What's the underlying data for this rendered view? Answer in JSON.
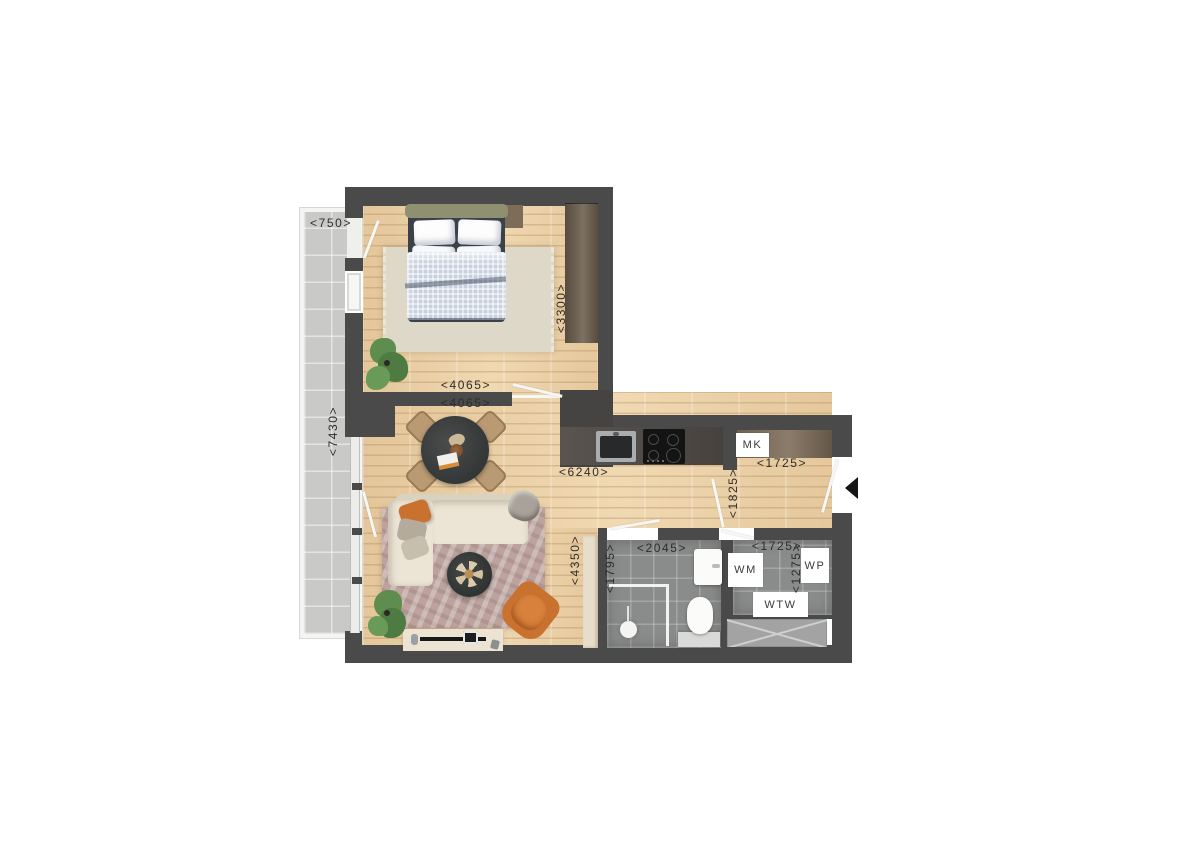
{
  "dimensions": {
    "balcony_width": "<750>",
    "balcony_length": "<7430>",
    "bedroom_depth": "<3300>",
    "bedroom_width": "<4065>",
    "living_width": "<4065>",
    "living_kitchen_length": "<6240>",
    "living_depth": "<4350>",
    "hall_depth": "<1825>",
    "hall_width": "<1725>",
    "bathroom_width": "<2045>",
    "bathroom_depth": "<1795>",
    "utility_width": "<1725>",
    "utility_depth": "<1275>"
  },
  "units": {
    "meter_cupboard": "MK",
    "washing_machine": "WM",
    "heat_recovery_unit": "WTW",
    "heat_pump": "WP"
  },
  "colors": {
    "wall": "#4a4a4b",
    "wood_floor": "#ebd2aa",
    "balcony_tile": "#c9cac7",
    "bath_tile": "#8a8c8b",
    "counter": "#504b46",
    "closet_wood": "#7b6a56",
    "accent_terracotta": "#c9722f",
    "rug_living": "#bda39e",
    "rug_bedroom": "#ddd8c8",
    "sofa_cream": "#ece5d6",
    "label_text": "#2d2d2d"
  }
}
